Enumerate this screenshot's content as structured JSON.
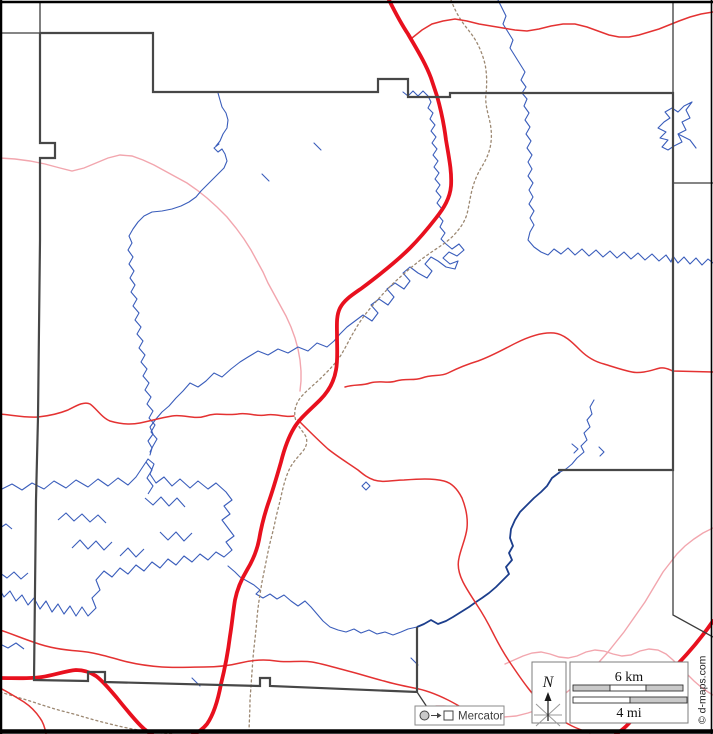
{
  "map": {
    "description": "blank county outline road map with rivers, highways and trails",
    "palette": {
      "frame_black": "#000000",
      "boundary_dark": "#3f3f3f",
      "boundary_light": "#8a8a8a",
      "highway_red": "#e8101e",
      "road_red": "#e43232",
      "road_pink": "#f2a6ae",
      "river_blue": "#3a5dbb",
      "river_navy": "#1c3e8c",
      "trail_brown": "#9c8872",
      "scale_fill_gray": "#c9c9c9"
    }
  },
  "north_indicator": {
    "label": "N"
  },
  "scale_bar": {
    "top_label": "6 km",
    "bottom_label": "4 mi"
  },
  "legend": {
    "projection": "Mercator"
  },
  "copyright": "© d-maps.com"
}
